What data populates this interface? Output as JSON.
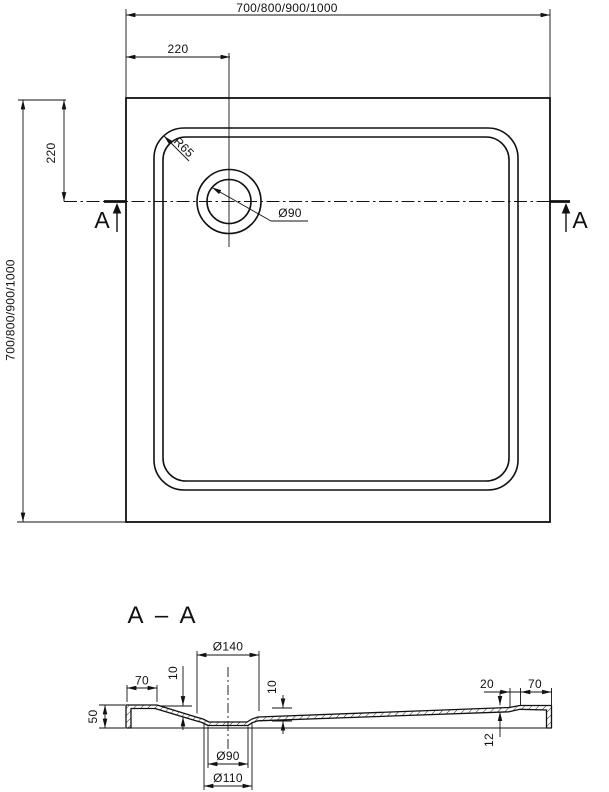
{
  "colors": {
    "ink": "#111111",
    "background": "#ffffff"
  },
  "top_view": {
    "width_dim": "700/800/900/1000",
    "height_dim": "700/800/900/1000",
    "drain_offset_x": "220",
    "drain_offset_y": "220",
    "corner_radius": "R65",
    "drain_diameter": "Ø90",
    "section_marker_left": "A",
    "section_marker_right": "A"
  },
  "section_view": {
    "title": "A – A",
    "recess_top_dia": "Ø140",
    "rim_left": "70",
    "drop_left": "10",
    "height": "50",
    "recess_depth": "10",
    "taper": "20",
    "rim_right": "70",
    "floor_thickness": "12",
    "drain_hole_dia": "Ø90",
    "recess_bottom_dia": "Ø110"
  }
}
